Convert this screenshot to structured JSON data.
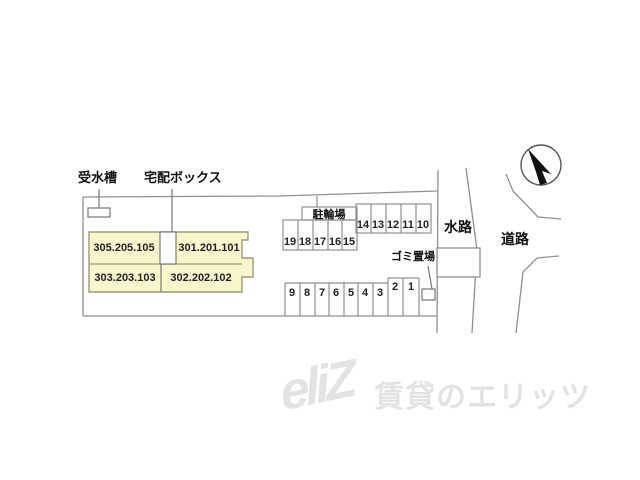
{
  "site_plan": {
    "labels": {
      "water_tank": "受水槽",
      "delivery_box": "宅配ボックス",
      "bicycle_parking": "駐輪場",
      "garbage_area": "ゴミ置場",
      "waterway": "水路",
      "road": "道路"
    },
    "building": {
      "units": [
        "305.205.105",
        "301.201.101",
        "303.203.103",
        "302.202.102"
      ]
    },
    "parking": {
      "bicycle_stalls": [
        "19",
        "18",
        "17",
        "16",
        "15"
      ],
      "car_stalls_upper": [
        "14",
        "13",
        "12",
        "11",
        "10"
      ],
      "car_stalls_lower": [
        "9",
        "8",
        "7",
        "6",
        "5",
        "4",
        "3",
        "2",
        "1"
      ]
    },
    "icons": {
      "compass": "north-arrow"
    }
  },
  "watermark": {
    "logo": "eliZ",
    "text": "賃貸のエリッツ"
  },
  "colors": {
    "building_fill": "#F9F6CE",
    "building_border": "#9B9B78",
    "boundary_line": "#8F8F8F",
    "divider_line": "#6E6E63",
    "text": "#1A1A1A",
    "watermark": "#E3E3E3",
    "compass_arrow": "#111111"
  }
}
